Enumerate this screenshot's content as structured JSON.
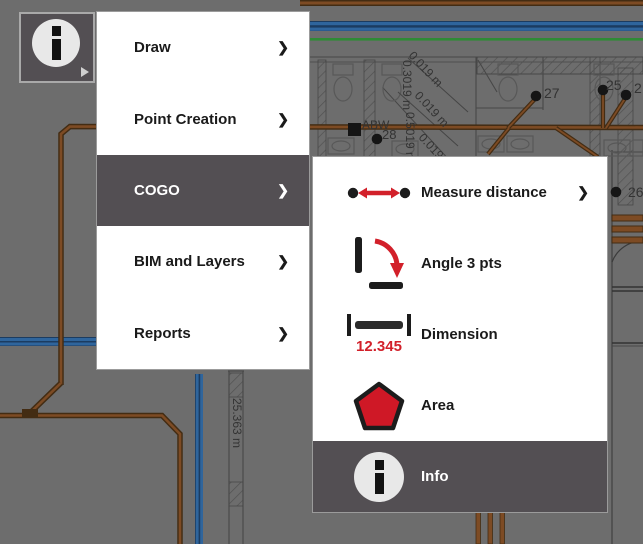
{
  "colors": {
    "bg_gray": "#6d6d6d",
    "panel_white": "#ffffff",
    "highlight_dark": "#534f53",
    "border_gray": "#9b9b9b",
    "text_dark": "#1a1a1a",
    "text_light": "#ffffff",
    "accent_red": "#d2202a",
    "pipe_brown": "#7d4b24",
    "pipe_brown_dark": "#432c13",
    "line_blue": "#2f659c",
    "line_blue_dark": "#1c3c60",
    "line_green": "#2e8b35",
    "plan_line": "#474747",
    "label_gray": "#333333"
  },
  "toolbar_button": {
    "icon": "info",
    "has_submenu_indicator": true
  },
  "icons": {
    "chevron_right": "❯"
  },
  "menu": {
    "items": [
      {
        "label": "Draw",
        "has_submenu": true,
        "selected": false
      },
      {
        "label": "Point Creation",
        "has_submenu": true,
        "selected": false
      },
      {
        "label": "COGO",
        "has_submenu": true,
        "selected": true
      },
      {
        "label": "BIM and Layers",
        "has_submenu": true,
        "selected": false
      },
      {
        "label": "Reports",
        "has_submenu": true,
        "selected": false
      }
    ]
  },
  "submenu": {
    "items": [
      {
        "label": "Measure distance",
        "icon": "measure-distance",
        "has_submenu": true,
        "selected": false
      },
      {
        "label": "Angle 3 pts",
        "icon": "angle-3pts",
        "has_submenu": false,
        "selected": false
      },
      {
        "label": "Dimension",
        "icon": "dimension",
        "icon_text": "12.345",
        "has_submenu": false,
        "selected": false
      },
      {
        "label": "Area",
        "icon": "area",
        "has_submenu": false,
        "selected": false
      },
      {
        "label": "Info",
        "icon": "info",
        "has_submenu": false,
        "selected": true
      }
    ]
  },
  "plan": {
    "labels": [
      {
        "text": "27",
        "x": 544,
        "y": 98,
        "rot": 0,
        "size": 14
      },
      {
        "text": "25",
        "x": 606,
        "y": 90,
        "rot": 0,
        "size": 14
      },
      {
        "text": "2",
        "x": 634,
        "y": 93,
        "rot": 0,
        "size": 14
      },
      {
        "text": "26",
        "x": 628,
        "y": 197,
        "rot": 0,
        "size": 14
      },
      {
        "text": "ABW",
        "x": 362,
        "y": 129,
        "rot": 0,
        "size": 12
      },
      {
        "text": "28",
        "x": 382,
        "y": 139,
        "rot": 0,
        "size": 13
      },
      {
        "text": "25.363 m",
        "x": 233,
        "y": 398,
        "rot": 90,
        "size": 12
      },
      {
        "text": "0.019 m",
        "x": 408,
        "y": 56,
        "rot": 47,
        "size": 12
      },
      {
        "text": "0.019 m",
        "x": 414,
        "y": 96,
        "rot": 47,
        "size": 12
      },
      {
        "text": "0.019 m",
        "x": 418,
        "y": 138,
        "rot": 47,
        "size": 12
      },
      {
        "text": "0.3019 m",
        "x": 403,
        "y": 60,
        "rot": 90,
        "size": 12
      },
      {
        "text": "0.5019 m",
        "x": 406,
        "y": 112,
        "rot": 90,
        "size": 12
      }
    ]
  }
}
